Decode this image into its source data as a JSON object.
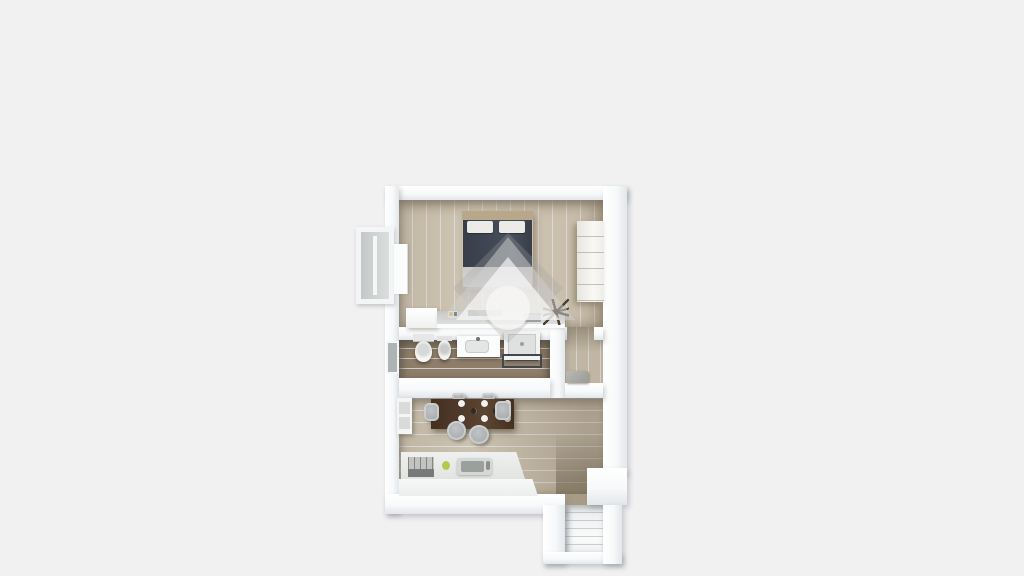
{
  "scene": {
    "title": "Top-down 3D render of a one-bedroom apartment floor plan on a plain light-gray background",
    "type": "3d-floorplan-render",
    "visible_text": "none"
  },
  "colors": {
    "bg": "#f1f1f2",
    "wall": "#f7f9fa",
    "wallEdge": "#e3e7ea",
    "floorBedroom": "#cdc2ae",
    "floorBath": "#8d7d69",
    "floorCloset": "#c6bca9",
    "floorLiving": "#c8bdaa",
    "corridor": "#a69b85",
    "duvet": "#3e4552",
    "headboard": "#b9a78c",
    "pillow": "#ecebe7",
    "sheet": "#dadbd9",
    "table": "#50392b",
    "plate": "#f2f1ee",
    "chair": "#a9adb0",
    "stove": "#c3c4c2",
    "sink": "#9aa09e",
    "greenItem": "#b5c84f",
    "plant": "#4c4335",
    "lamp": "#d6b84a",
    "doormat": "#9a9a97",
    "wmDiamond": "rgba(160,160,160,0.28)",
    "wmTriOuter": "rgba(208,208,208,0.5)",
    "wmTriInner": "rgba(255,255,255,0.62)",
    "wmCircle": "rgba(247,247,246,0.78)"
  },
  "rooms": [
    {
      "id": "bedroom",
      "position": "top",
      "floor": "light oak planks (vertical)",
      "objects": [
        "double-bed",
        "headboard",
        "two-pillows",
        "navy-duvet",
        "foot-blanket",
        "wardrobe",
        "console-desk",
        "tv",
        "desk-lamp",
        "laptop",
        "side-cabinet",
        "plant",
        "window",
        "balcony"
      ]
    },
    {
      "id": "bathroom",
      "position": "middle-left",
      "floor": "dark walnut planks",
      "objects": [
        "toilet",
        "bidet",
        "vanity-sink",
        "shower",
        "towel-rack",
        "window"
      ]
    },
    {
      "id": "closet-hall",
      "position": "middle-right",
      "floor": "light oak planks",
      "objects": [
        "doormat"
      ]
    },
    {
      "id": "living-kitchen",
      "position": "bottom",
      "floor": "light oak planks (horizontal)",
      "objects": [
        "fridge",
        "dining-table",
        "six-plates",
        "two-bottles",
        "six-chairs",
        "kitchen-counter",
        "cooktop",
        "kitchen-sink",
        "green-item"
      ]
    },
    {
      "id": "entrance-vestibule",
      "position": "bottom-right",
      "floor": "white",
      "objects": [
        "front-door"
      ]
    }
  ],
  "watermark": {
    "description": "semi-transparent diamond logo with an upward house/arrow shape and a circle, centered over the plan"
  },
  "table_setting": {
    "plates": 6,
    "plate_rows": 2,
    "bottles": 2,
    "chairs": 6
  }
}
